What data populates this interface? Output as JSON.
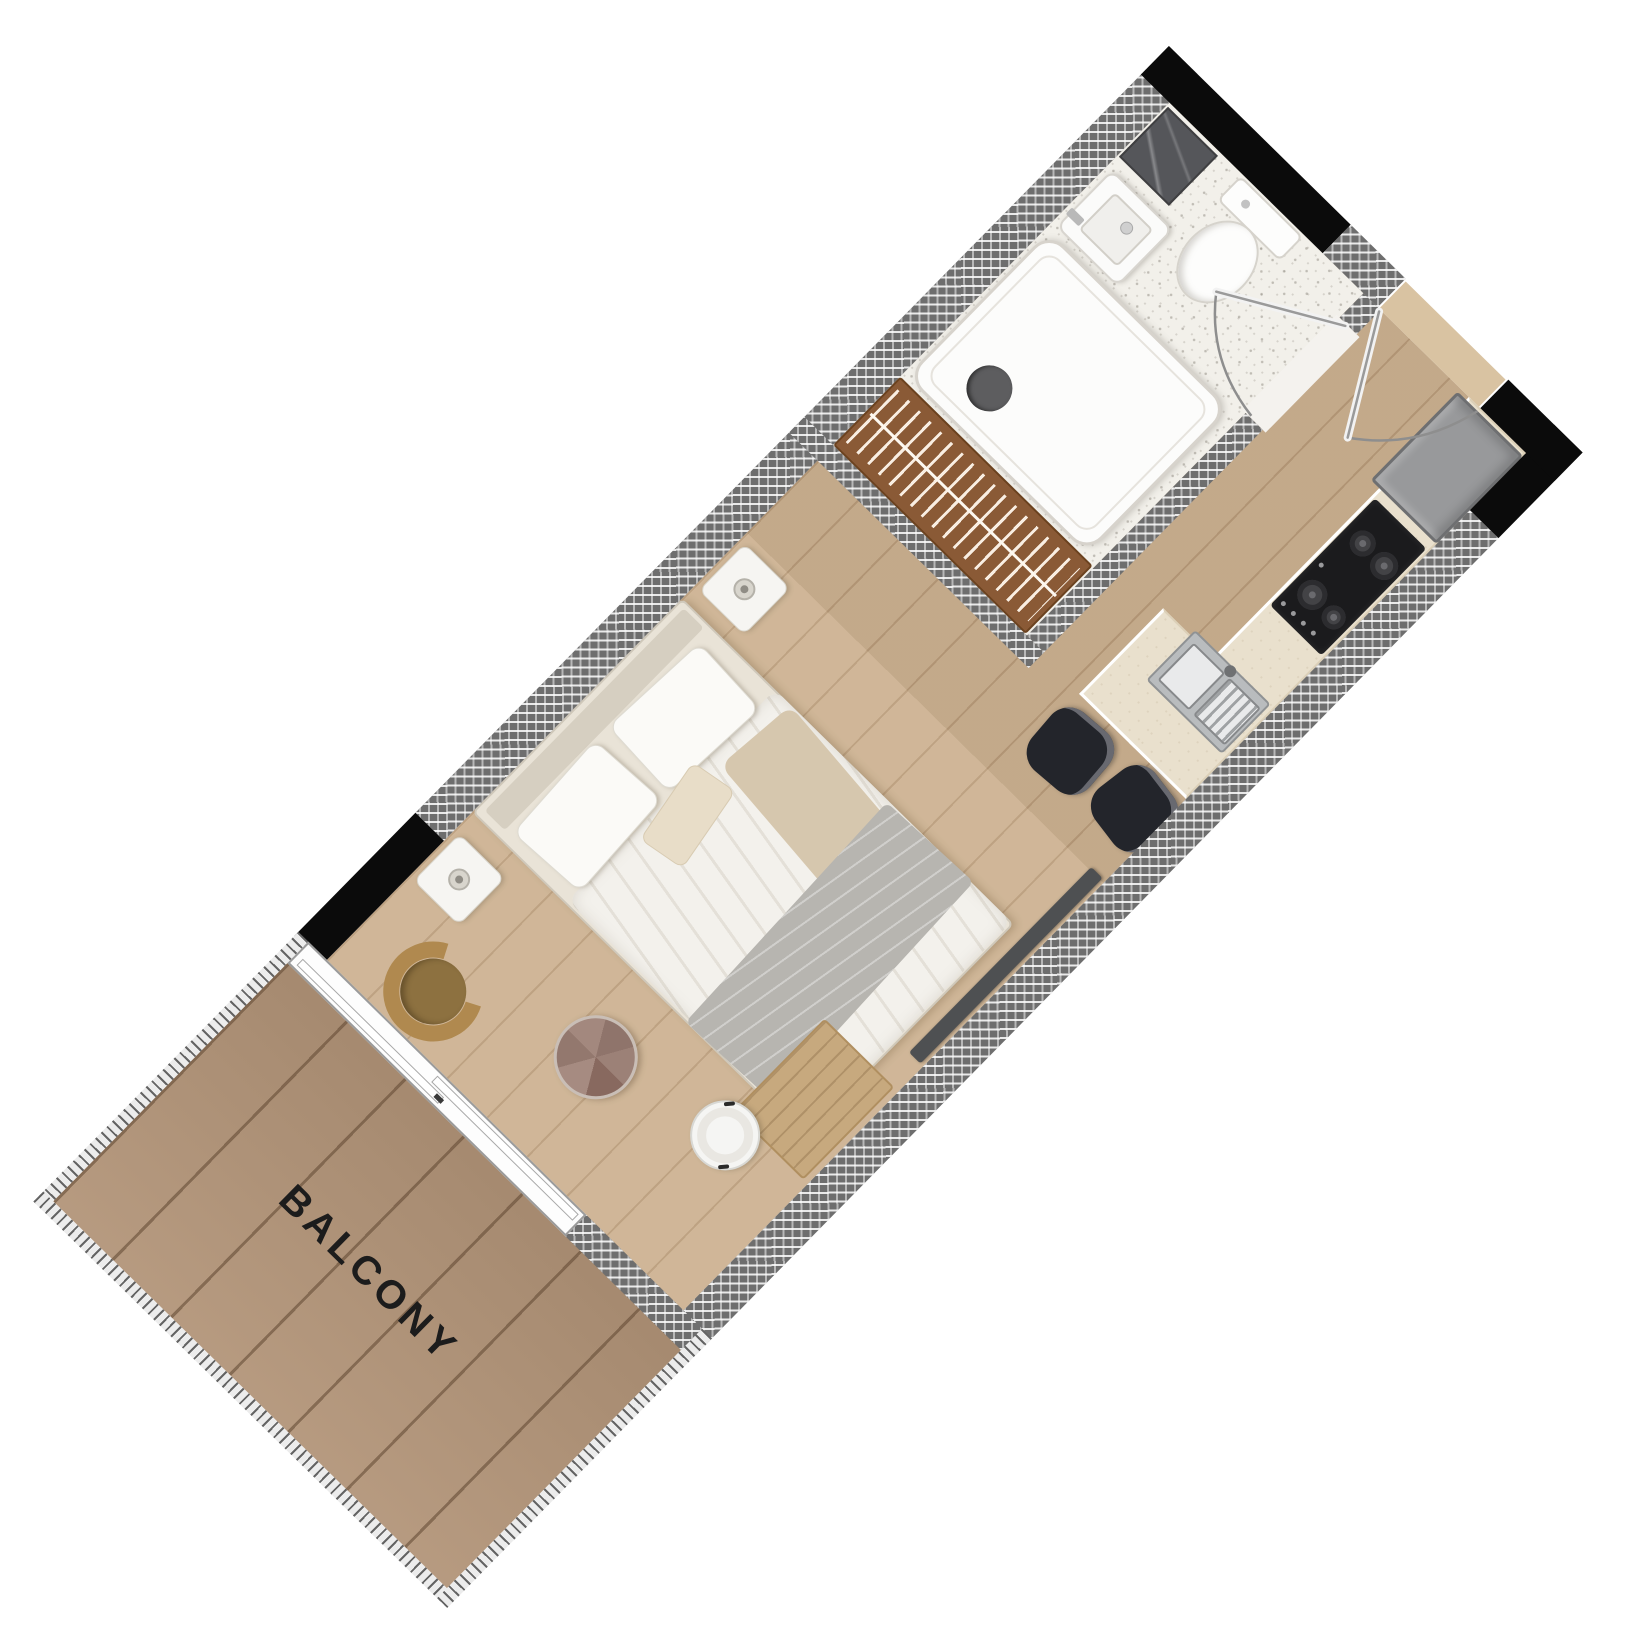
{
  "floorplan": {
    "balcony_label": "BALCONY",
    "rooms": [
      "balcony",
      "living-sleeping-area",
      "bathroom",
      "kitchen",
      "entry-hall"
    ],
    "furniture": [
      "double-bed",
      "nightstand-left",
      "nightstand-right",
      "wardrobe-with-hangers",
      "armchair",
      "coffee-table",
      "side-table",
      "tv",
      "wood-mat",
      "bar-stool-1",
      "bar-stool-2",
      "kitchen-counter",
      "kitchen-sink",
      "cooktop",
      "fridge",
      "shower-tray",
      "wash-basin",
      "toilet",
      "marble-counter",
      "sliding-balcony-door",
      "entry-door",
      "bathroom-door"
    ],
    "colors": {
      "wall_hatch": "#6e6e6e",
      "wall_black": "#0b0b0b",
      "room_floor": "#ccb190",
      "balcony_floor": "#b29478",
      "bathroom_floor": "#f2f0ea",
      "counter": "#e9e0cd",
      "fridge": "#98999b",
      "cooktop": "#1b1b1d",
      "wardrobe": "#8a5a36",
      "armchair": "#b0894f",
      "coffee_table": "#9a8278",
      "stool": "#23252b",
      "label_text": "#1c1c1c"
    }
  }
}
